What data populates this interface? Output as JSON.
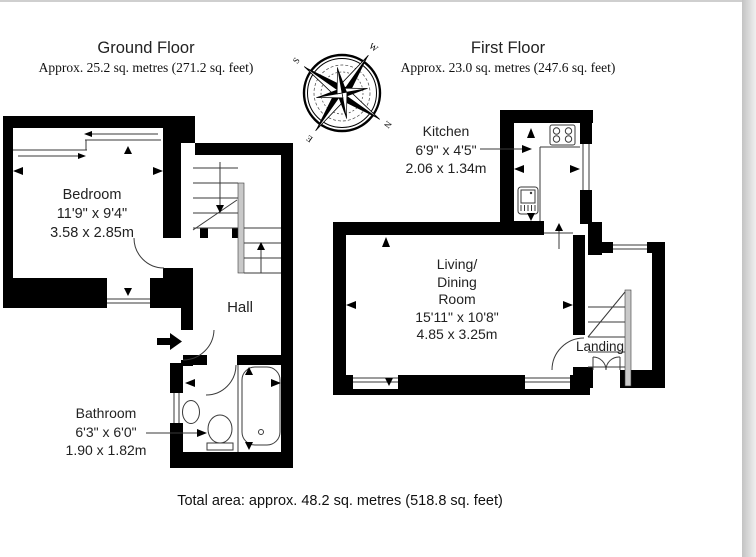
{
  "header": {
    "ground": {
      "title": "Ground Floor",
      "area": "Approx. 25.2 sq. metres (271.2 sq. feet)"
    },
    "first": {
      "title": "First Floor",
      "area": "Approx. 23.0 sq. metres (247.6 sq. feet)"
    }
  },
  "rooms": {
    "bedroom": {
      "name": "Bedroom",
      "imperial": "11'9\" x 9'4\"",
      "metric": "3.58 x 2.85m"
    },
    "hall": {
      "name": "Hall"
    },
    "bathroom": {
      "name": "Bathroom",
      "imperial": "6'3\" x 6'0\"",
      "metric": "1.90 x 1.82m"
    },
    "kitchen": {
      "name": "Kitchen",
      "imperial": "6'9\" x 4'5\"",
      "metric": "2.06 x 1.34m"
    },
    "living": {
      "line1": "Living/",
      "line2": "Dining",
      "line3": "Room",
      "imperial": "15'11\" x 10'8\"",
      "metric": "4.85 x 3.25m"
    },
    "landing": {
      "name": "Landing"
    }
  },
  "compass": {
    "n": "N",
    "e": "E",
    "s": "S",
    "w": "W"
  },
  "footer": {
    "total": "Total area: approx. 48.2 sq. metres (518.8 sq. feet)"
  },
  "colors": {
    "wall": "#000000",
    "thin_line": "#3a3a3a",
    "page": "#ffffff",
    "edge_strip": "#c3c3c3",
    "top_line": "#cfcfcf"
  }
}
